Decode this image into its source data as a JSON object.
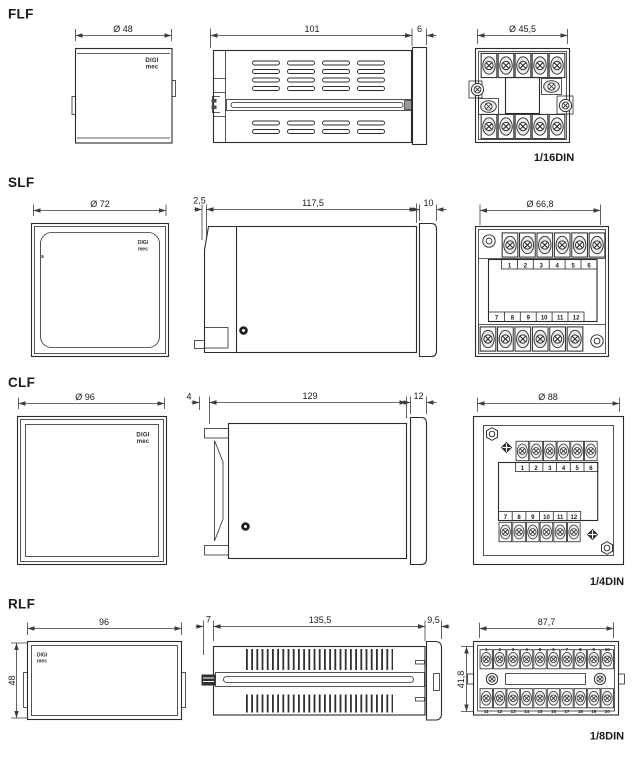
{
  "colors": {
    "line": "#2b2b2b",
    "dimension": "#3c3c3c",
    "background": "#ffffff",
    "dark_fill": "#1f1f1f"
  },
  "brand": {
    "logo_line1": "DIGI",
    "logo_line2": "mec"
  },
  "flf": {
    "label": "FLF",
    "front": {
      "width_dim": "Ø 48"
    },
    "side": {
      "body_dim": "101",
      "bezel_dim": "6"
    },
    "rear": {
      "width_dim": "Ø 45,5",
      "din_label": "1/16DIN"
    }
  },
  "slf": {
    "label": "SLF",
    "front": {
      "width_dim": "Ø 72",
      "marking": "s"
    },
    "side": {
      "flange_dim": "2,5",
      "body_dim": "117,5",
      "bezel_dim": "10"
    },
    "rear": {
      "width_dim": "Ø 66,8",
      "terminals_top": [
        "1",
        "2",
        "3",
        "4",
        "5",
        "6"
      ],
      "terminals_bottom": [
        "7",
        "8",
        "9",
        "10",
        "11",
        "12"
      ]
    }
  },
  "clf": {
    "label": "CLF",
    "front": {
      "width_dim": "Ø 96"
    },
    "side": {
      "flange_dim": "4",
      "body_dim": "129",
      "bezel_dim": "12"
    },
    "rear": {
      "width_dim": "Ø 88",
      "terminals_top": [
        "1",
        "2",
        "3",
        "4",
        "5",
        "6"
      ],
      "terminals_bottom": [
        "7",
        "8",
        "9",
        "10",
        "11",
        "12"
      ],
      "din_label": "1/4DIN"
    }
  },
  "rlf": {
    "label": "RLF",
    "front": {
      "width_dim": "96",
      "height_dim": "48"
    },
    "side": {
      "flange_dim": "7",
      "body_dim": "135,5",
      "bezel_dim": "9,5"
    },
    "rear": {
      "width_dim": "87,7",
      "height_dim": "41,8",
      "terminals_top": [
        "1",
        "2",
        "3",
        "4",
        "5",
        "6",
        "7",
        "8",
        "9",
        "10"
      ],
      "terminals_bottom": [
        "11",
        "12",
        "13",
        "14",
        "15",
        "16",
        "17",
        "18",
        "19",
        "20"
      ],
      "din_label": "1/8DIN"
    }
  }
}
